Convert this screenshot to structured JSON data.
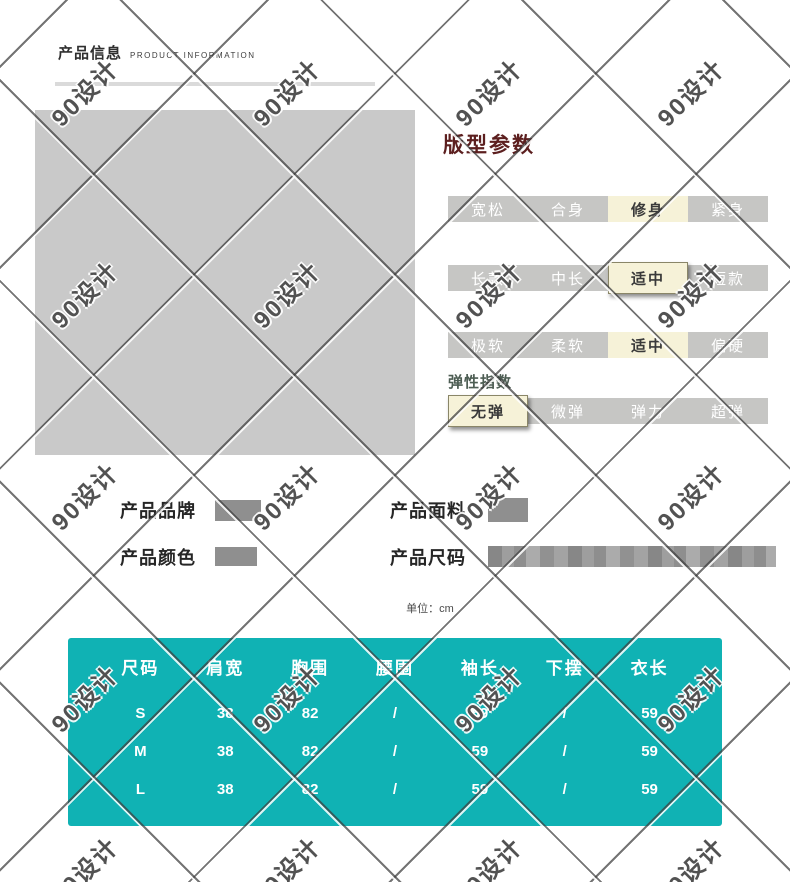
{
  "watermark": {
    "text": "90设计"
  },
  "header": {
    "title": "产品信息",
    "subtitle": "PRODUCT INFORMATION"
  },
  "params_panel": {
    "title": "版型参数",
    "elasticity_label": "弹性指数",
    "rows": [
      {
        "options": [
          "宽松",
          "合身",
          "修身",
          "紧身"
        ],
        "selected_index": 2
      },
      {
        "options": [
          "长款",
          "中长",
          "适中",
          "短款"
        ],
        "selected_index": 2
      },
      {
        "options": [
          "极软",
          "柔软",
          "适中",
          "偏硬"
        ],
        "selected_index": 2
      },
      {
        "options": [
          "无弹",
          "微弹",
          "弹力",
          "超弹"
        ],
        "selected_index": 0
      }
    ]
  },
  "product_info": {
    "brand_label": "产品品牌",
    "fabric_label": "产品面料",
    "color_label": "产品颜色",
    "size_label": "产品尺码"
  },
  "size_table": {
    "note": "单位：cm",
    "headers": [
      "尺码",
      "肩宽",
      "胸围",
      "腰围",
      "袖长",
      "下摆",
      "衣长"
    ],
    "rows": [
      [
        "S",
        "38",
        "82",
        "/",
        "59",
        "/",
        "59"
      ],
      [
        "M",
        "38",
        "82",
        "/",
        "59",
        "/",
        "59"
      ],
      [
        "L",
        "38",
        "82",
        "/",
        "59",
        "/",
        "59"
      ]
    ]
  },
  "colors": {
    "table_teal": "#10b2b4",
    "option_bar_gray": "#c6c6c4",
    "selected_cream": "#f6f2d8",
    "section_title_red": "#5c1f1f",
    "placeholder_gray": "#c9c9c9"
  }
}
